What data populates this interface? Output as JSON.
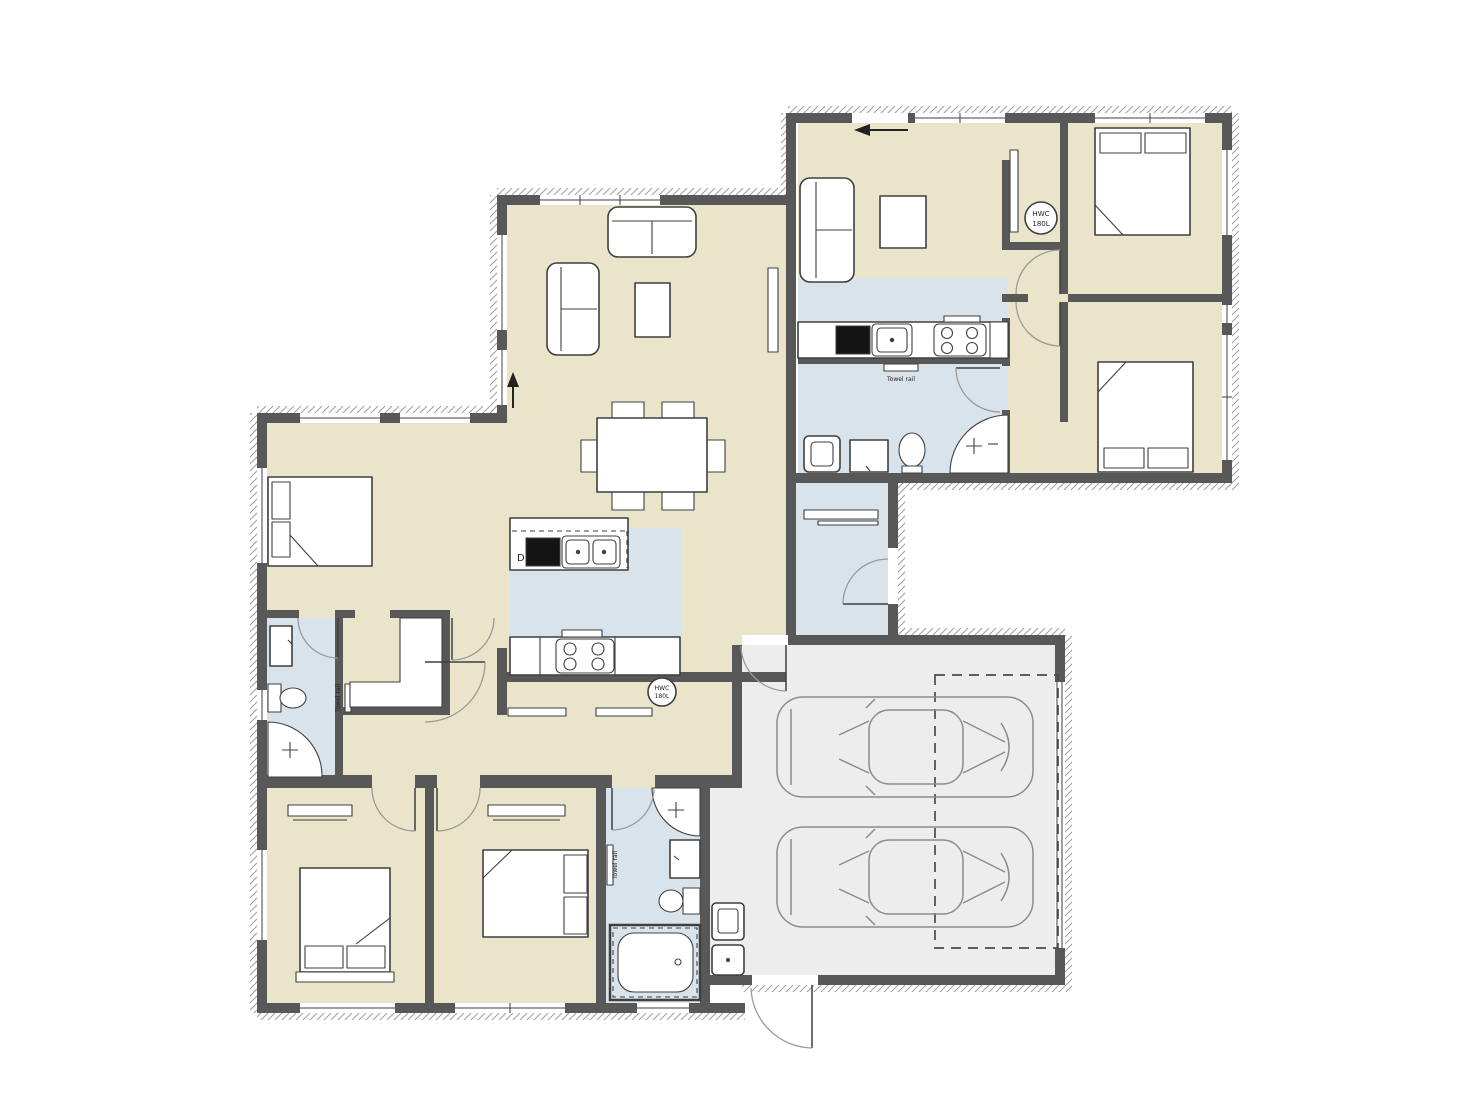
{
  "plan": {
    "type": "residential-floor-plan",
    "areas": [
      "main-house",
      "secondary-unit",
      "double-garage"
    ]
  },
  "labels": {
    "dishwasher": "D",
    "hwc": {
      "line1": "HWC",
      "line2": "180L"
    },
    "towel_rail": "Towel rail"
  },
  "colors": {
    "wall": "#585858",
    "room": "#eae5ca",
    "wet": "#d9e3ec",
    "garage": "#ededed",
    "line": "#3f3f3f",
    "arc": "#9a9a9a",
    "hatch": "#9f9f9f",
    "paper": "#ffffff",
    "furniture": "#ffffff",
    "dash": "#4a4a4a",
    "carline": "#8c8c8c",
    "text": "#222222"
  }
}
